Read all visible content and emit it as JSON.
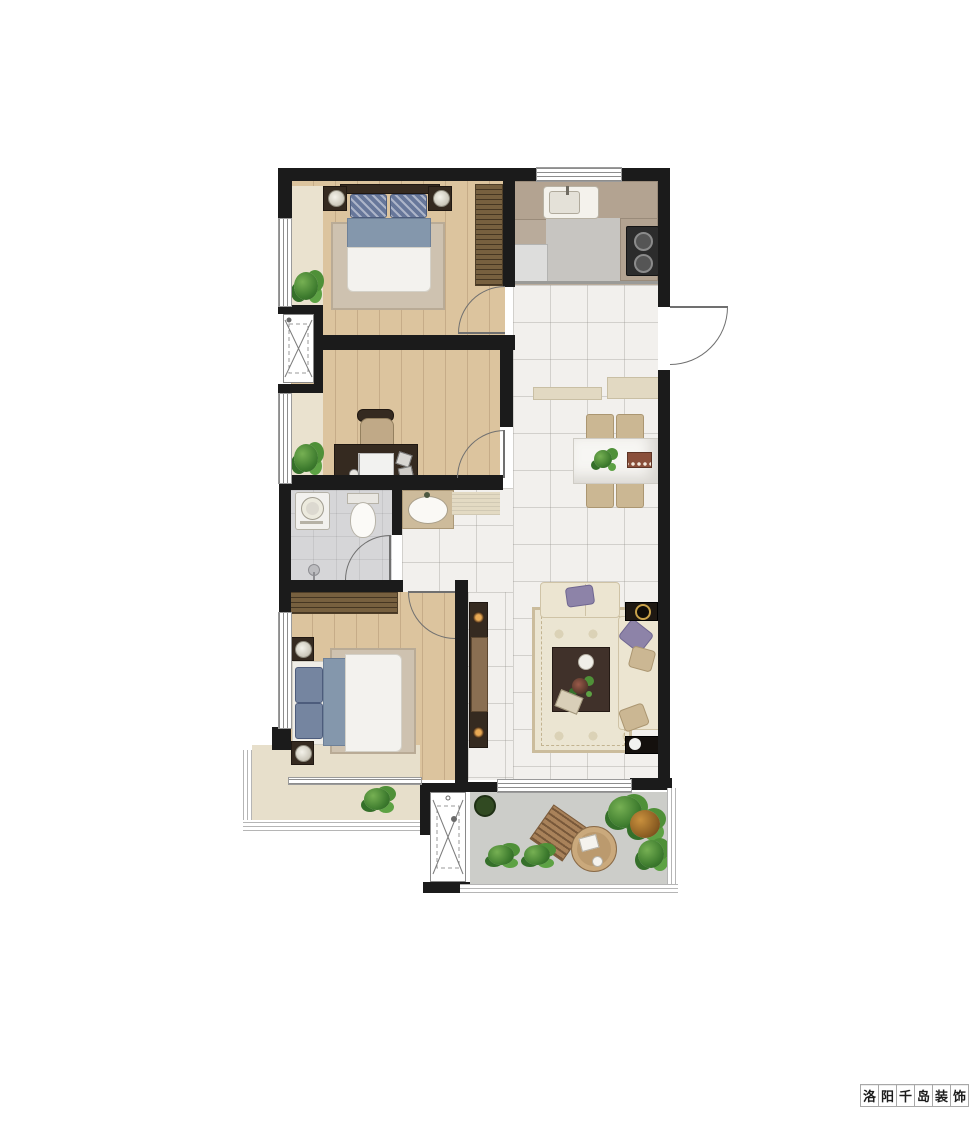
{
  "watermark": {
    "text": "洛阳千岛装饰",
    "chars": [
      "洛",
      "阳",
      "千",
      "岛",
      "装",
      "饰"
    ]
  },
  "palette": {
    "wall": "#1b1b1b",
    "wood_floor": "#dcc49e",
    "bay_floor": "#eae2cf",
    "tile_floor": "#f2f0ed",
    "bathroom_floor": "#d6d6d8",
    "kitchen_floor": "#c7c5c1",
    "terrace_floor": "#cccdc9",
    "counter": "#b3a391",
    "living_rug": "#ebe5d2",
    "sofa_cream": "#ece5d1",
    "accent_pillow_purple": "#8d83a8",
    "bed_blanket_blue": "#8497ac",
    "dark_furniture": "#352a20",
    "dining_chair_tan": "#c2aa8c",
    "plant_green": "#3c7a2d"
  },
  "plan": {
    "type": "residential-floor-plan",
    "symbols": [
      "double-bed",
      "wardrobe",
      "nightstand",
      "desk",
      "desk-chair",
      "kitchen-sink",
      "gas-stove",
      "fridge",
      "dining-table",
      "dining-chair",
      "toilet",
      "washing-machine",
      "wash-basin",
      "shower",
      "l-sofa",
      "coffee-table",
      "tv-cabinet",
      "side-table",
      "speaker",
      "door-swing",
      "window",
      "railing",
      "utility-shaft",
      "plant",
      "outdoor-chair",
      "outdoor-table"
    ]
  }
}
